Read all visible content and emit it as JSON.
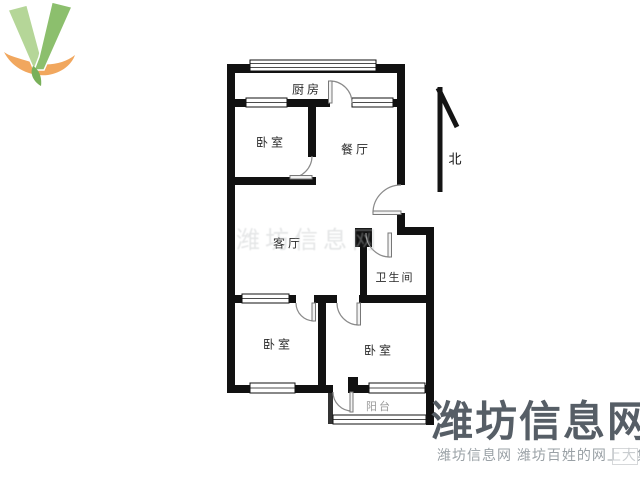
{
  "page": {
    "background": "#ffffff"
  },
  "floorplan": {
    "type": "apartment-floor-plan",
    "rooms": [
      {
        "id": "kitchen",
        "label": "厨房"
      },
      {
        "id": "bedroom-north",
        "label": "卧室"
      },
      {
        "id": "dining-room",
        "label": "餐厅"
      },
      {
        "id": "living-room",
        "label": "客厅"
      },
      {
        "id": "bathroom",
        "label": "卫生间"
      },
      {
        "id": "bedroom-southwest",
        "label": "卧室"
      },
      {
        "id": "bedroom-southeast",
        "label": "卧室"
      },
      {
        "id": "balcony",
        "label": "阳台"
      }
    ],
    "compass_label": "北",
    "wall_color": "#111111"
  },
  "watermark": {
    "faint_text": "潍坊信息网",
    "brand_text": "潍坊信息网",
    "tagline_text": "潍坊信息网 潍坊百姓的网上大集",
    "brand_color": "#565e66",
    "tagline_color": "#9aa1a6",
    "logo_green_light": "#b5d698",
    "logo_green_dark": "#8cbf6d",
    "logo_orange": "#f1a75e"
  }
}
